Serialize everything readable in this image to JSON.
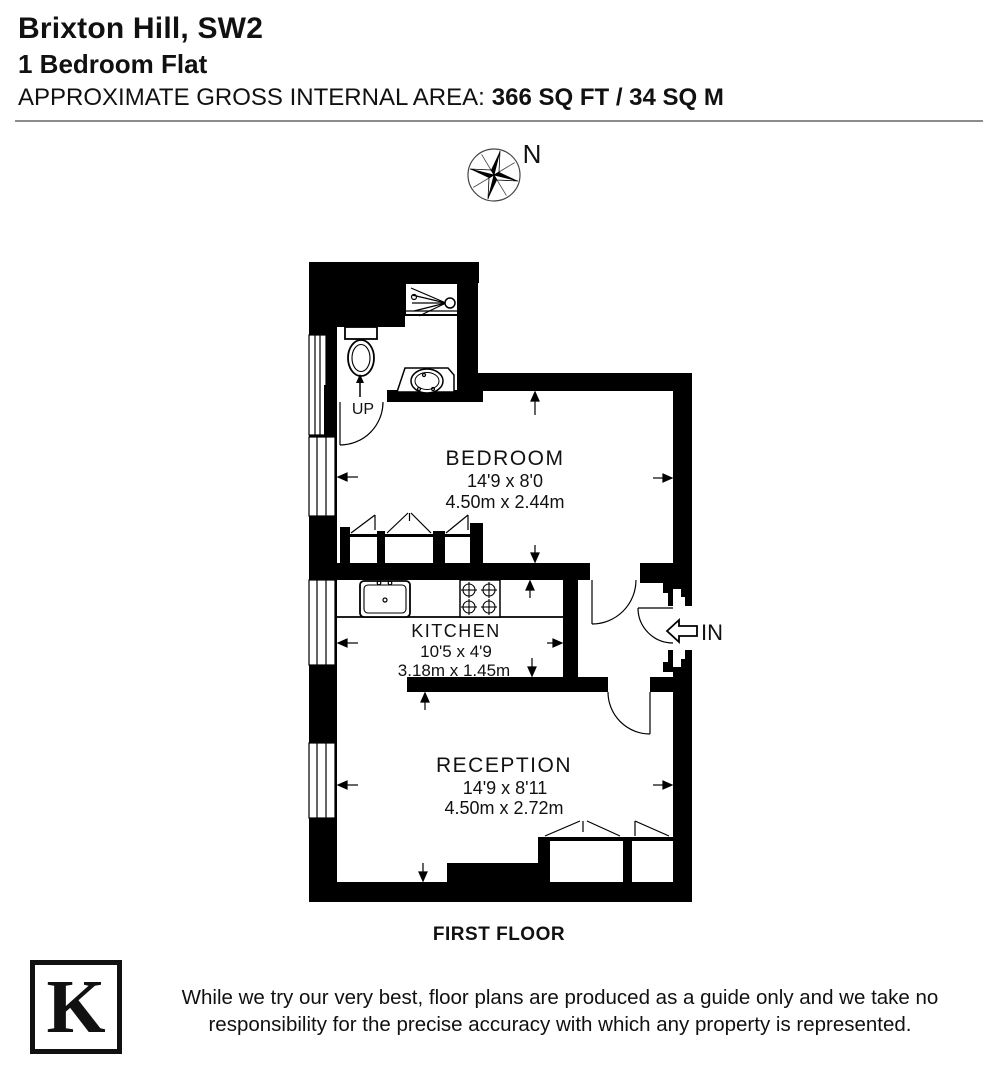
{
  "header": {
    "address": "Brixton Hill, SW2",
    "property_type": "1 Bedroom Flat",
    "area_label": "APPROXIMATE GROSS INTERNAL AREA:",
    "area_value": "366 SQ FT / 34 SQ M"
  },
  "compass": {
    "north_label": "N"
  },
  "plan": {
    "floor_label": "FIRST FLOOR",
    "stairs_label": "UP",
    "entrance_label": "IN",
    "rooms": [
      {
        "name": "BEDROOM",
        "imperial": "14'9 x 8'0",
        "metric": "4.50m x 2.44m"
      },
      {
        "name": "KITCHEN",
        "imperial": "10'5 x 4'9",
        "metric": "3.18m x 1.45m"
      },
      {
        "name": "RECEPTION",
        "imperial": "14'9 x 8'11",
        "metric": "4.50m x 2.72m"
      }
    ]
  },
  "footer": {
    "logo_letter": "K",
    "disclaimer_line1": "While we try our very best, floor plans are produced as a guide only and we take no",
    "disclaimer_line2": "responsibility for the precise accuracy with which any property is represented."
  },
  "colors": {
    "wall": "#000000",
    "divider": "#8c8c8c",
    "text": "#111111"
  }
}
